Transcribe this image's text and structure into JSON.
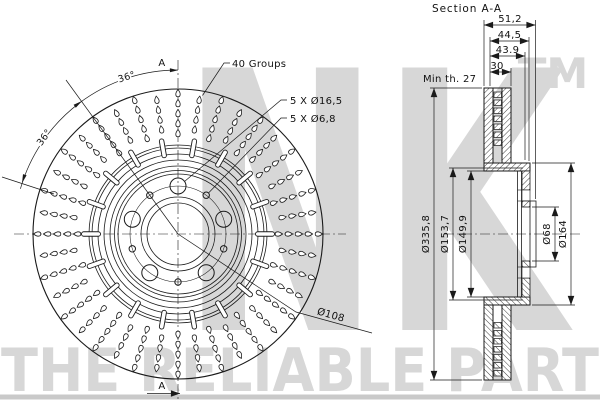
{
  "colors": {
    "background": "#ffffff",
    "line": "#1a1a1a",
    "watermark": "#d7d7d7",
    "watermark_bar": "#c9c9c9"
  },
  "watermark": {
    "brand": "NK",
    "trademark": "TM",
    "tagline": "THE RELIABLE PART"
  },
  "front_view": {
    "groups_label": "40 Groups",
    "bolt_holes_label": "5 X Ø16,5",
    "pin_holes_label": "5 X Ø6,8",
    "bolt_circle_label": "Ø108",
    "angle_upper_label": "36°",
    "angle_lower_label": "36°",
    "section_arrow_top": "A",
    "section_arrow_bottom": "A",
    "hole_groups_count": 40
  },
  "section_view": {
    "title": "Section A-A",
    "overall_width": "51,2",
    "width_to_pilot": "44,5",
    "width_inner": "43.9",
    "disc_thickness": "30",
    "min_thickness_note": "Min th. 27",
    "outer_diameter": "Ø335,8",
    "hat_diameter_outer": "Ø153,7",
    "hat_diameter_inner": "Ø149,9",
    "bore_diameter": "Ø68",
    "pilot_diameter": "Ø164"
  }
}
